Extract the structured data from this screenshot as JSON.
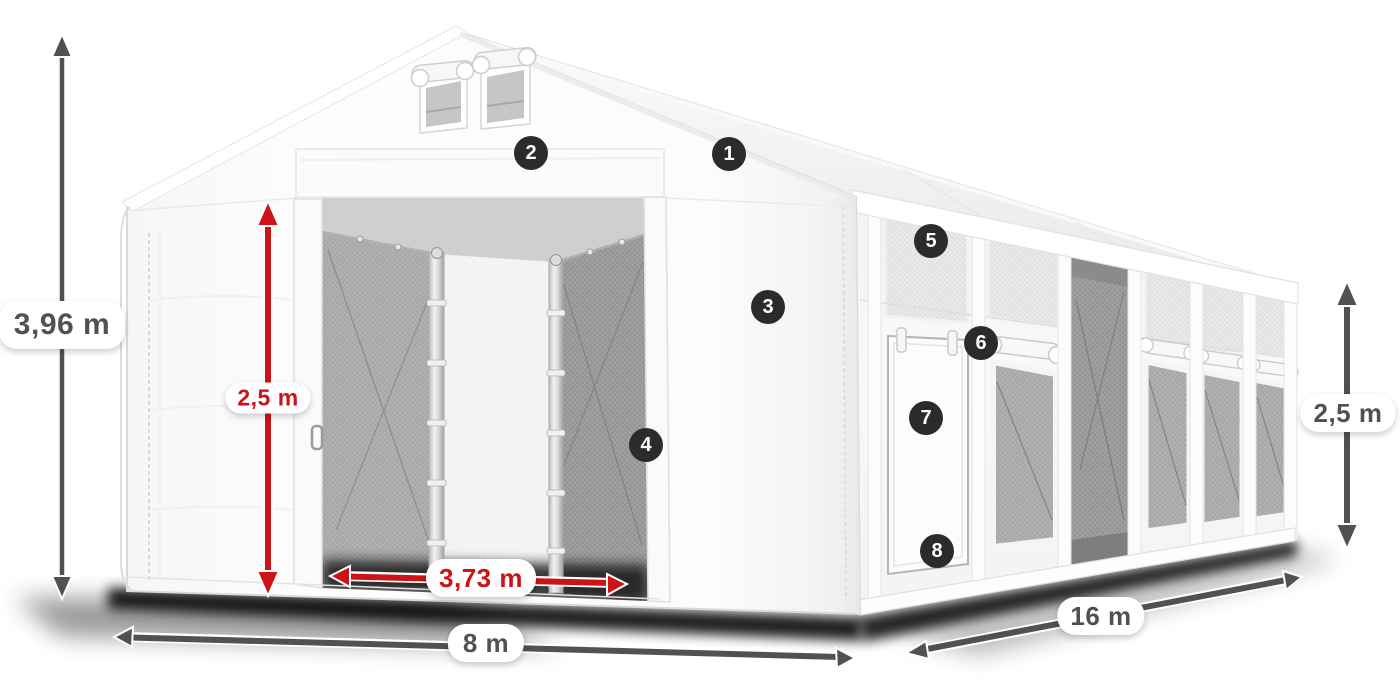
{
  "diagram": {
    "type": "product-dimension-diagram",
    "subject": "white marquee storage tent with open sliding gate, side door, mesh windows, dimension arrows and numbered feature callouts"
  },
  "dimensions": {
    "total_height": "3,96 m",
    "left_side_height": "2,5 m",
    "door_width": "3,73 m",
    "front_width": "8 m",
    "side_length": "16 m",
    "right_side_height": "2,5 m"
  },
  "callouts": [
    {
      "number": "1"
    },
    {
      "number": "2"
    },
    {
      "number": "3"
    },
    {
      "number": "4"
    },
    {
      "number": "5"
    },
    {
      "number": "6"
    },
    {
      "number": "7"
    },
    {
      "number": "8"
    }
  ],
  "colors": {
    "dimension_dark": "#515154",
    "dimension_red": "#cb1318",
    "badge_background": "#2b2b2d",
    "badge_text": "#ffffff",
    "tent_white": "#fdfdfd",
    "mesh_gray": "#b2b2b2"
  }
}
